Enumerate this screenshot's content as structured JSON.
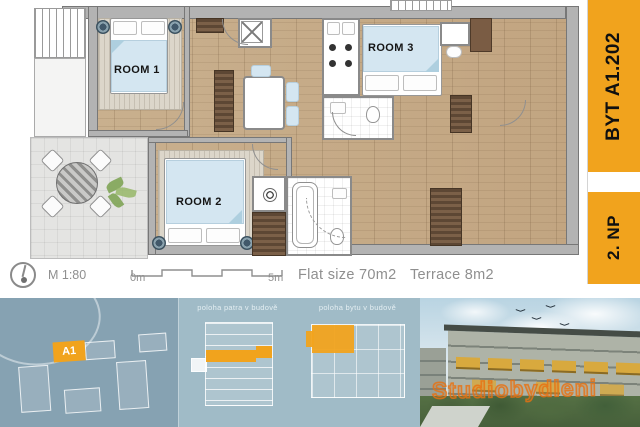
{
  "plan": {
    "room1": "ROOM 1",
    "room2": "ROOM 2",
    "room3": "ROOM 3",
    "scale_label": "M 1:80",
    "scale_start": "0m",
    "scale_end": "5m",
    "flat_size": "Flat size 70m2",
    "terrace_size": "Terrace 8m2"
  },
  "sidebar": {
    "unit": "BYT A1.202",
    "floor": "2. NP",
    "accent_color": "#F1A31D"
  },
  "strip": {
    "site_building_label": "A1",
    "section_caption": "poloha patra v budově",
    "plan_caption": "poloha bytu v budově",
    "watermark": "Studiobydleni",
    "site_bg_color": "#86A2B2",
    "panel_bg_color": "#A0BBC7"
  }
}
